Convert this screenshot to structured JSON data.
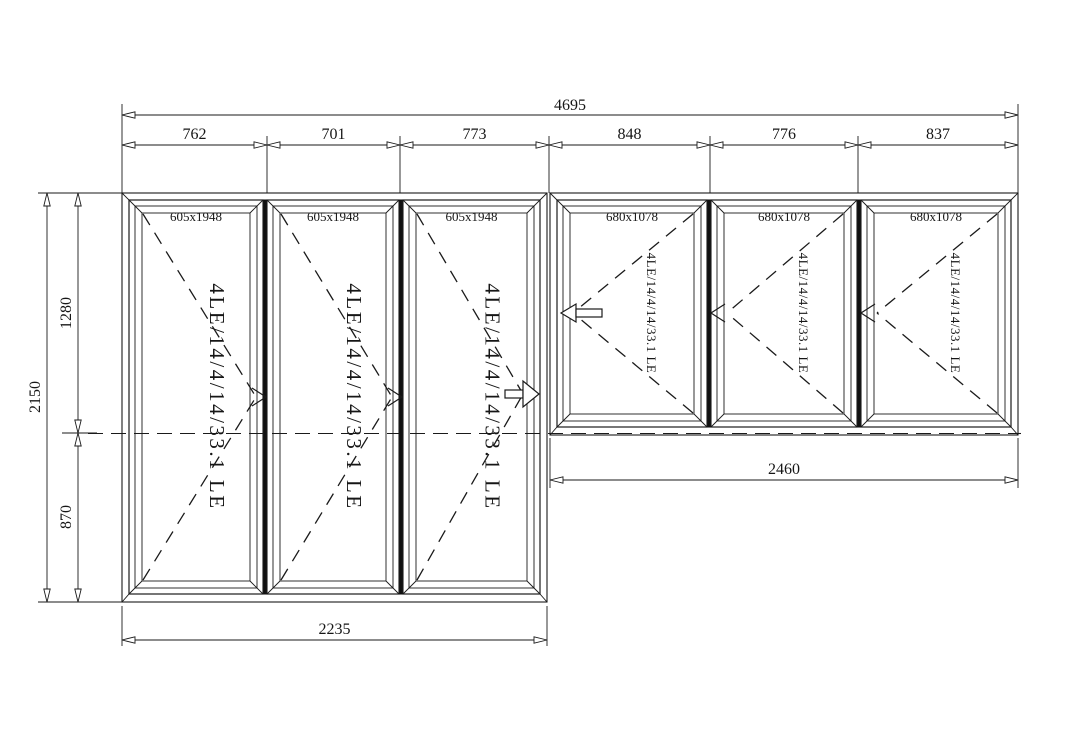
{
  "drawing": {
    "background": "#ffffff",
    "line_color": "#1a1a1a",
    "dims": {
      "overall_width": "4695",
      "top_segments": [
        "762",
        "701",
        "773",
        "848",
        "776",
        "837"
      ],
      "overall_height": "2150",
      "left_upper": "1280",
      "left_lower": "870",
      "bottom_left": "2235",
      "bottom_right": "2460"
    },
    "left_group": {
      "panels": [
        {
          "size": "605x1948",
          "glass": "4LE/14/4/14/33.1 LE"
        },
        {
          "size": "605x1948",
          "glass": "4LE/14/4/14/33.1 LE"
        },
        {
          "size": "605x1948",
          "glass": "4LE/14/4/14/33.1 LE"
        }
      ]
    },
    "right_group": {
      "panels": [
        {
          "size": "680x1078",
          "glass": "4LE/14/4/14/33.1 LE"
        },
        {
          "size": "680x1078",
          "glass": "4LE/14/4/14/33.1 LE"
        },
        {
          "size": "680x1078",
          "glass": "4LE/14/4/14/33.1 LE"
        }
      ]
    }
  }
}
